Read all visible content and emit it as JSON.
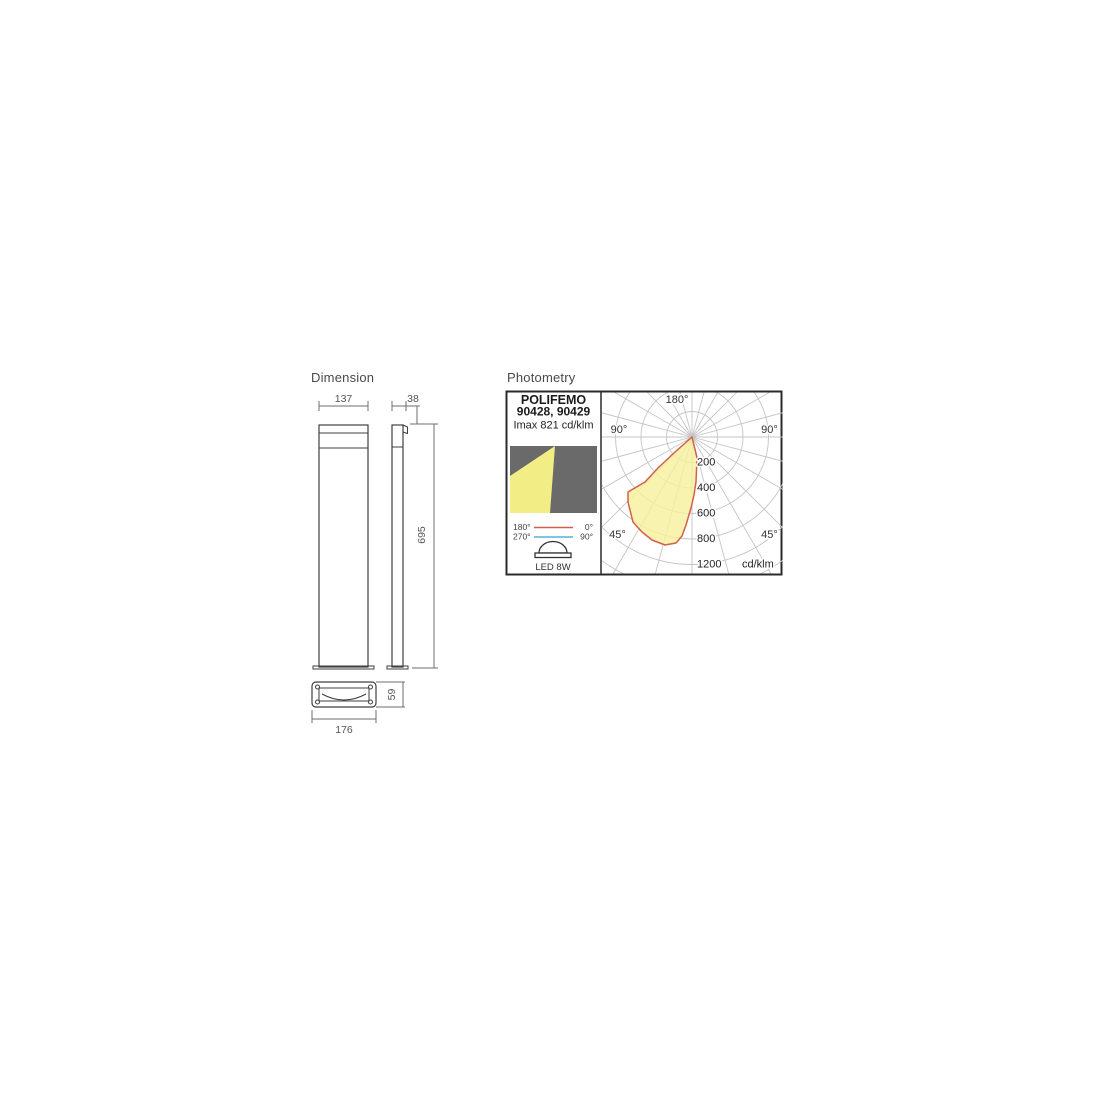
{
  "dimension_section": {
    "title": "Dimension",
    "labels": {
      "front_width": "137",
      "side_depth": "38",
      "height": "695",
      "base_height": "59",
      "base_width": "176"
    }
  },
  "photometry_section": {
    "title": "Photometry",
    "header": {
      "product": "POLIFEMO",
      "codes": "90428, 90429",
      "imax": "Imax 821 cd/klm"
    },
    "legend": {
      "plane0_left": "180°",
      "plane0_right": "0°",
      "plane90_left": "270°",
      "plane90_right": "90°",
      "lamp": "LED 8W"
    },
    "polar_labels": {
      "top": "180°",
      "left90": "90°",
      "right90": "90°",
      "left45": "45°",
      "right45": "45°",
      "unit": "cd/klm",
      "rings": [
        "200",
        "400",
        "600",
        "800",
        "1200"
      ]
    },
    "colors": {
      "c0_curve": "#d2604a",
      "c90_curve": "#55b0d5",
      "beam_fill": "#f6f09c",
      "icon_beam_yellow": "#f2ee85",
      "icon_bg_gray": "#6a6a6a",
      "grid_gray": "#c5c5c8"
    }
  },
  "chart_data": {
    "type": "polar",
    "title": "POLIFEMO 90428, 90429",
    "subtitle": "Imax 821 cd/klm",
    "unit": "cd/klm",
    "ring_values": [
      200,
      400,
      600,
      800,
      1200
    ],
    "angle_step_deg": 15,
    "legend_planes": [
      {
        "name": "C0-180",
        "color": "#d2604a"
      },
      {
        "name": "C90-270",
        "color": "#55b0d5"
      }
    ],
    "beam_summary": {
      "imax_cd_per_klm": 821,
      "peak_gamma_deg": 15,
      "cutoff_gamma_deg": 50,
      "lobe_side": "left-down"
    },
    "series": [
      {
        "name": "C0-180 plane",
        "color": "#d2604a",
        "points_gamma_deg_cd": [
          [
            0,
            545
          ],
          [
            5,
            650
          ],
          [
            10,
            760
          ],
          [
            15,
            821
          ],
          [
            20,
            815
          ],
          [
            25,
            800
          ],
          [
            30,
            780
          ],
          [
            35,
            750
          ],
          [
            40,
            705
          ],
          [
            45,
            650
          ],
          [
            48,
            560
          ],
          [
            50,
            420
          ],
          [
            52,
            250
          ],
          [
            55,
            120
          ],
          [
            60,
            40
          ],
          [
            90,
            0
          ]
        ]
      }
    ],
    "curve_outline_px": [
      [
        0,
        0
      ],
      [
        5,
        21
      ],
      [
        4,
        45
      ],
      [
        2,
        58
      ],
      [
        -1,
        71
      ],
      [
        -6,
        88
      ],
      [
        -10,
        99
      ],
      [
        -16,
        106
      ],
      [
        -27,
        108
      ],
      [
        -40,
        103
      ],
      [
        -50,
        95
      ],
      [
        -59,
        85
      ],
      [
        -64,
        65
      ],
      [
        -64,
        55
      ],
      [
        -47,
        45
      ],
      [
        -34,
        31
      ],
      [
        -17,
        15
      ]
    ],
    "px_per_200cd": 25.5
  }
}
